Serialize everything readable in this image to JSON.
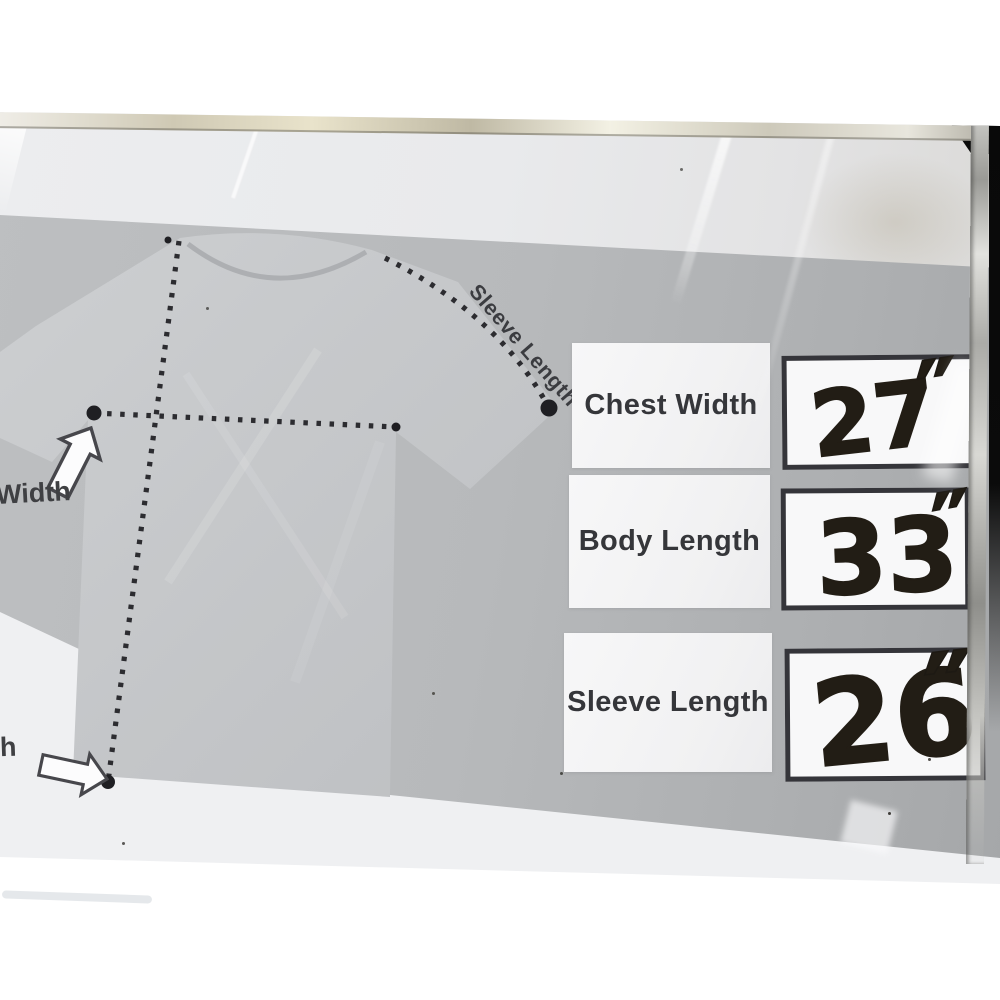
{
  "diagram": {
    "sleeve_line_label": "Sleeve Length",
    "chest_width_partial_label": "Width",
    "body_length_partial_label": "h"
  },
  "size_table": {
    "rows": [
      {
        "label": "Chest Width",
        "value": "27",
        "unit": "″"
      },
      {
        "label": "Body Length",
        "value": "33",
        "unit": "″"
      },
      {
        "label": "Sleeve Length",
        "value": "26",
        "unit": "″"
      }
    ]
  },
  "colors": {
    "card_white": "#ebecee",
    "band_gray": "#b5b7b9",
    "shirt_gray": "#c7c9cb",
    "dotted_line_ink": "#2c2c30",
    "label_text": "#35363a",
    "value_box_border": "#35353a",
    "marker_ink": "#221d15",
    "frame_metal": "#d8d4c4",
    "backdrop_black": "#0a0a0a"
  }
}
